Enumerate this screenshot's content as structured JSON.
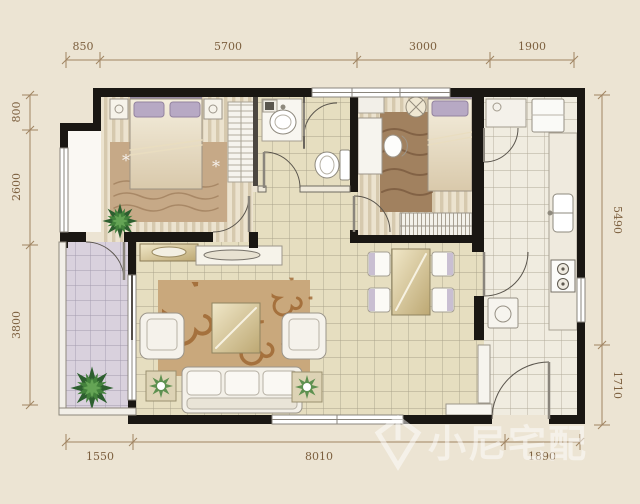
{
  "plan": {
    "dimensions": {
      "top": [
        "850",
        "5700",
        "3000",
        "1900"
      ],
      "left": [
        "800",
        "2600",
        "3800"
      ],
      "right": [
        "5490",
        "1710"
      ],
      "bottom": [
        "1550",
        "8010",
        "1890"
      ]
    },
    "watermark": "小尼宅配",
    "colors": {
      "background": "#ece4d3",
      "wall": "#1a1713",
      "dimension_text": "#7c5f3e",
      "tile_beige": "#e6dec0",
      "tile_kitchen": "#f0ece0",
      "balcony_lavender": "#d9d1dd",
      "rug_tan": "#c9a87c",
      "plant_green": "#43823c",
      "watermark_color": "#ffffff"
    }
  }
}
